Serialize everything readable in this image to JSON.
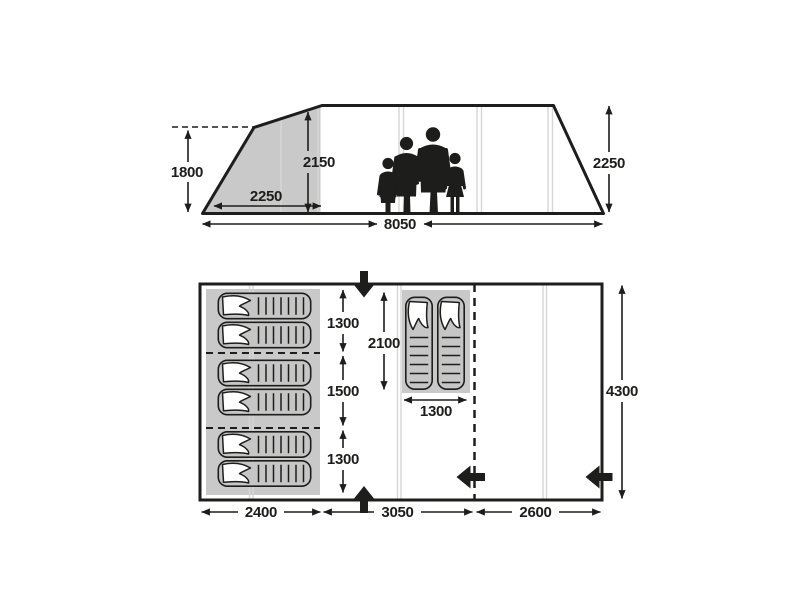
{
  "title": "Tent dimensions technical diagram",
  "labels": {
    "side": {
      "height_left": "1800",
      "porch_width": "2250",
      "inner_height": "2150",
      "total_length": "8050",
      "height_right": "2250"
    },
    "plan": {
      "seg_top": "1300",
      "seg_mid": "1500",
      "seg_bottom": "1300",
      "mid_length": "2100",
      "mid_width": "1300",
      "total_depth": "4300",
      "w_left": "2400",
      "w_mid": "3050",
      "w_right": "2600"
    }
  },
  "features": {
    "sleeping_bags_left_count": 6,
    "sleeping_bags_middle_count": 2,
    "people_silhouettes_count": 4,
    "entrance_arrow_icons": [
      "arrow-down-top-entrance",
      "arrow-up-bottom-entrance",
      "arrow-left-divider-entrance",
      "arrow-left-right-entrance"
    ]
  },
  "colors": {
    "line": "#1d1d1b",
    "panel": "#c9c9c9",
    "bag": "#c6c6c6",
    "seam": "#d6d6d6",
    "background": "#ffffff"
  }
}
